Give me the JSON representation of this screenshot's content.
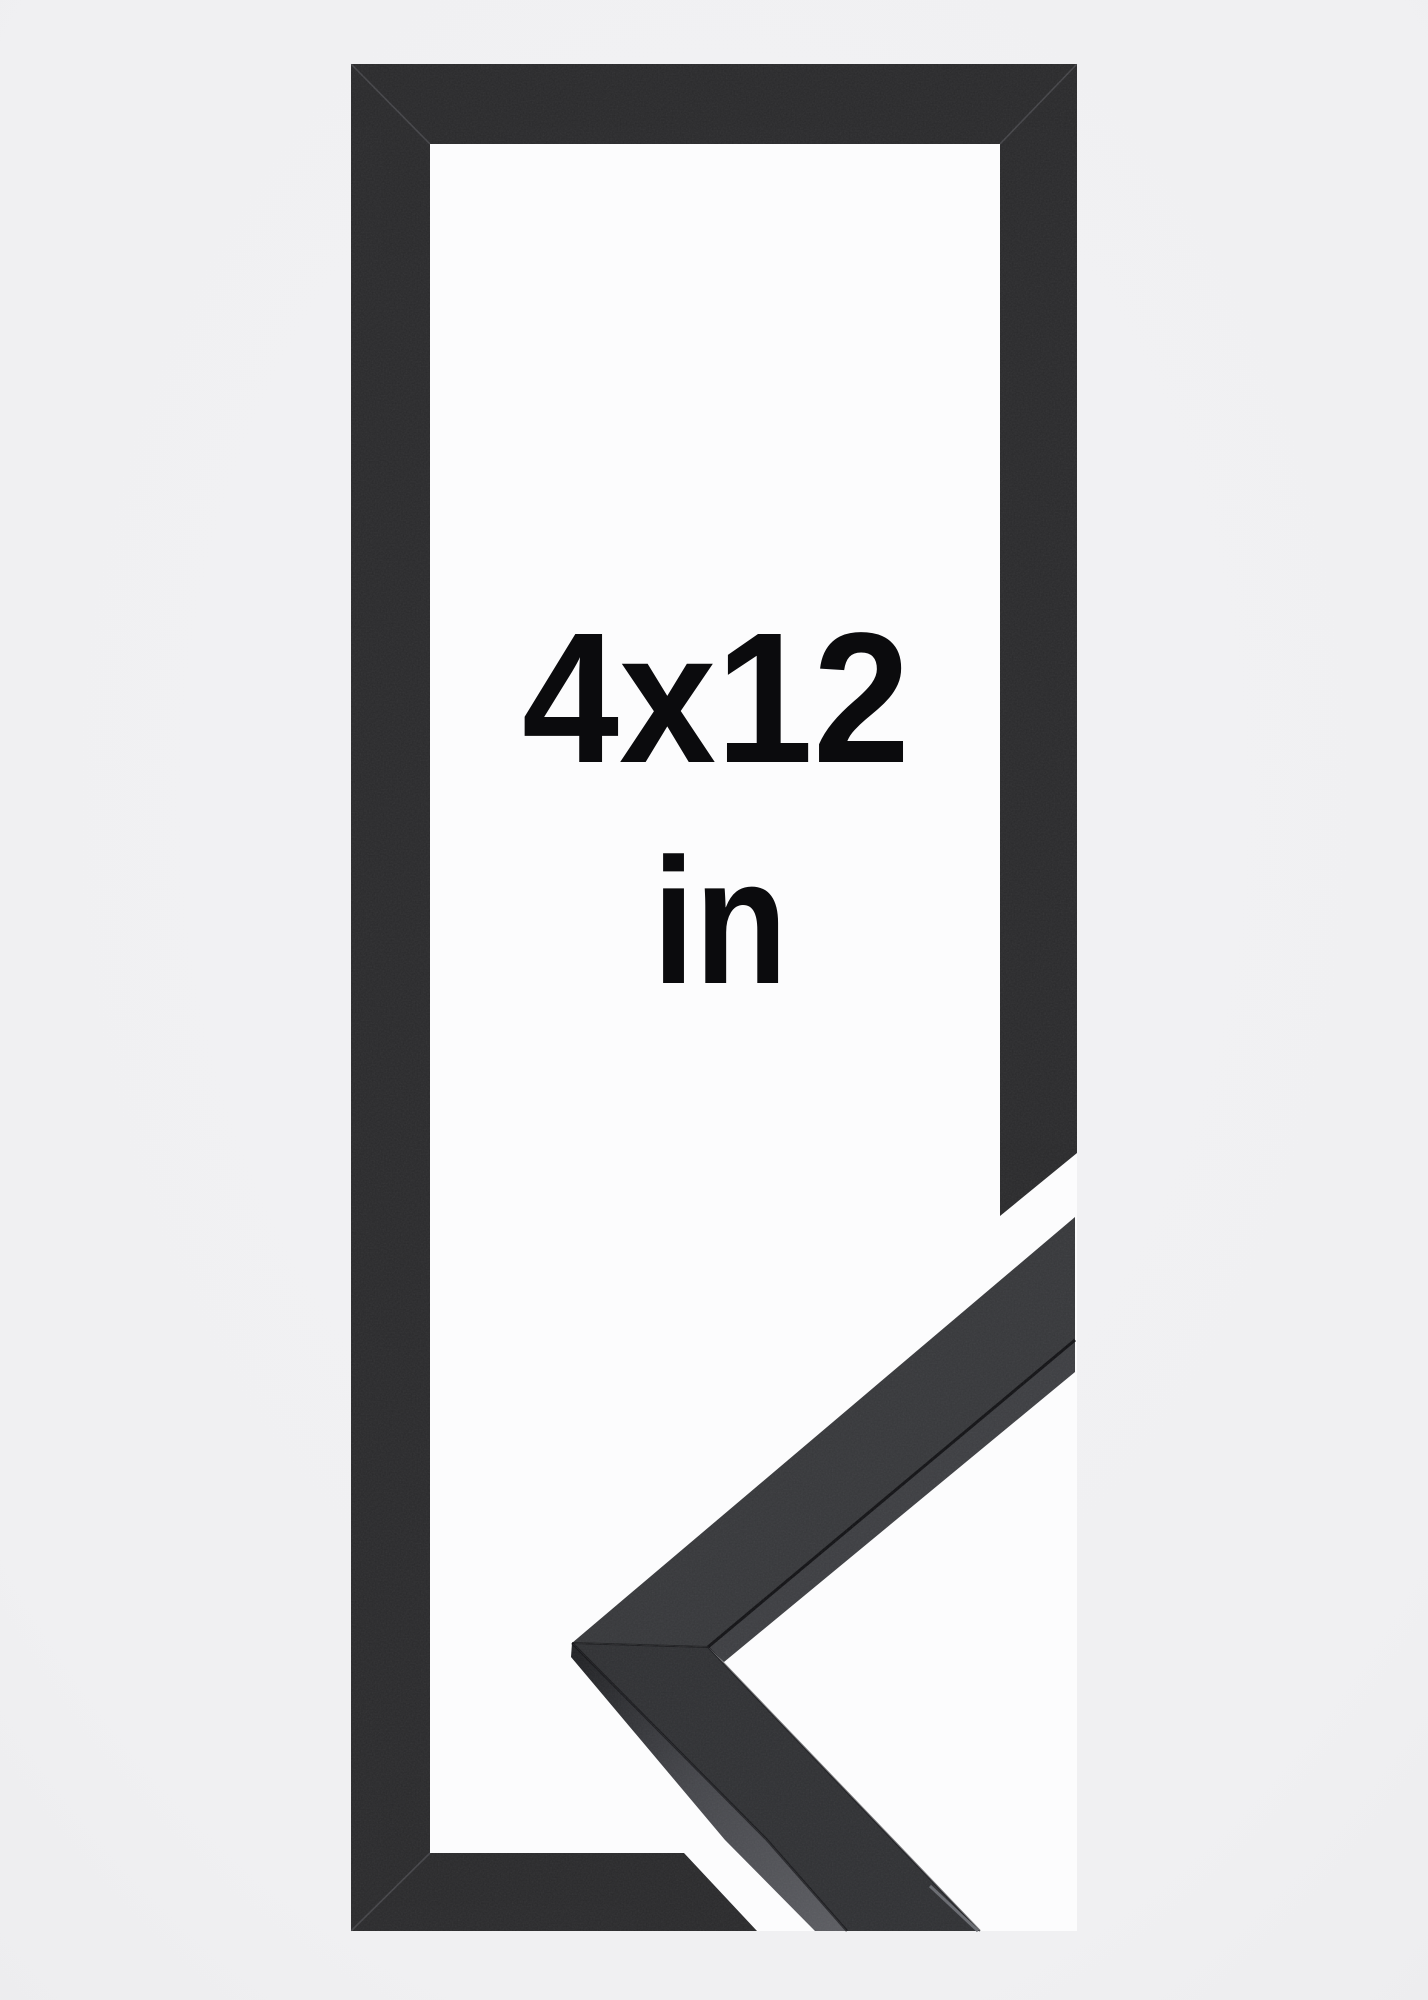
{
  "frame": {
    "size_label": "4x12",
    "unit_label": "in"
  },
  "colors": {
    "page_background": "#f1f1f2",
    "backdrop_white": "#fcfcfd",
    "frame_black": "#2a2a2c",
    "moulding_top_upper_leg": "#37383b",
    "moulding_top_lower_leg": "#303134",
    "moulding_inner_side": "#3d3e42",
    "label_text": "#0b0b0d"
  }
}
